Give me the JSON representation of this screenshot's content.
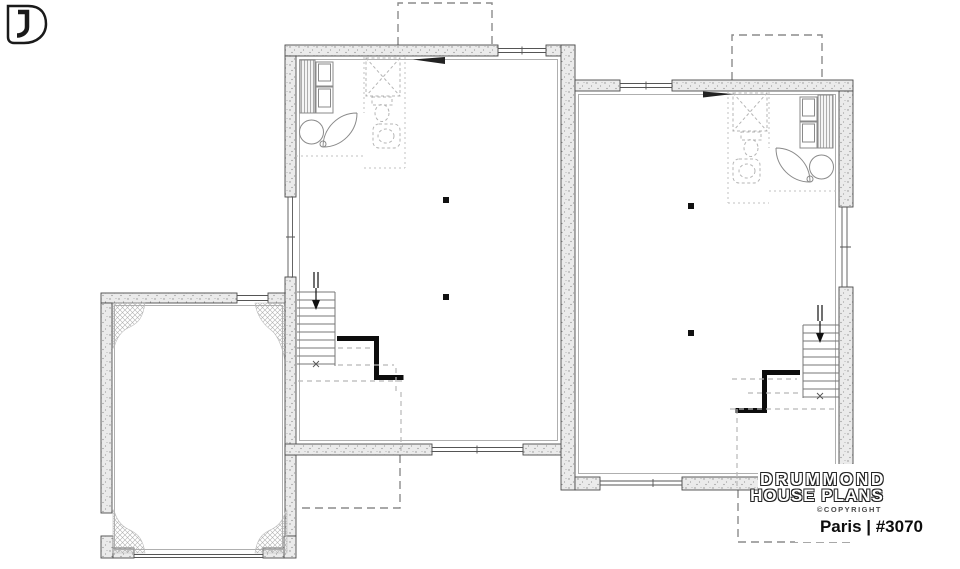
{
  "branding": {
    "name_line1": "DRUMMOND",
    "name_line2": "HOUSE PLANS",
    "copyright": "©COPYRIGHT",
    "plan_title": "Paris | #3070"
  },
  "colors": {
    "wall_texture": "#ebebeb",
    "line": "#4a4a4a",
    "dashed_gray": "#9a9a9a",
    "black": "#111111",
    "background": "#ffffff"
  }
}
